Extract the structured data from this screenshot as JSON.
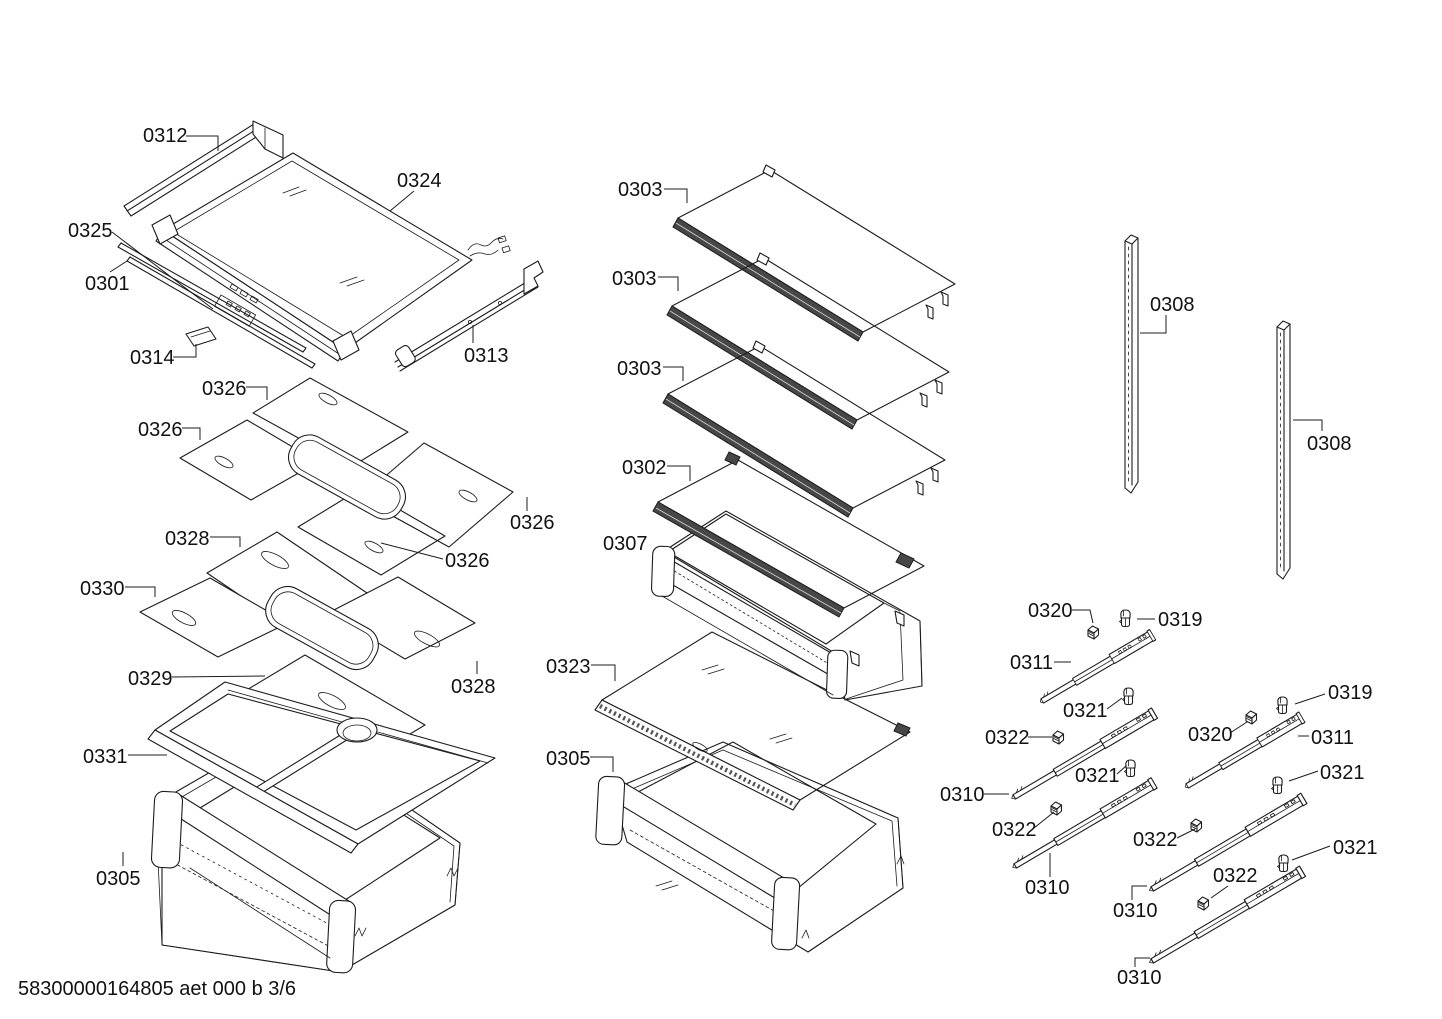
{
  "doc": {
    "footer_code": "58300000164805 aet 000 b 3/6",
    "type_note": "exploded-parts-diagram"
  },
  "colors": {
    "background": "#ffffff",
    "line": "#1c1c1c",
    "dark_edge": "#474747"
  },
  "labels": [
    {
      "text": "0312",
      "x": 143,
      "y": 142
    },
    {
      "text": "0324",
      "x": 397,
      "y": 187
    },
    {
      "text": "0325",
      "x": 68,
      "y": 237
    },
    {
      "text": "0301",
      "x": 85,
      "y": 290
    },
    {
      "text": "0314",
      "x": 130,
      "y": 364
    },
    {
      "text": "0313",
      "x": 464,
      "y": 362
    },
    {
      "text": "0326",
      "x": 202,
      "y": 395
    },
    {
      "text": "0326",
      "x": 138,
      "y": 436
    },
    {
      "text": "0326",
      "x": 510,
      "y": 529
    },
    {
      "text": "0326",
      "x": 445,
      "y": 567
    },
    {
      "text": "0328",
      "x": 165,
      "y": 545
    },
    {
      "text": "0330",
      "x": 80,
      "y": 595
    },
    {
      "text": "0329",
      "x": 128,
      "y": 685
    },
    {
      "text": "0328",
      "x": 451,
      "y": 693
    },
    {
      "text": "0331",
      "x": 83,
      "y": 763
    },
    {
      "text": "0305",
      "x": 96,
      "y": 885
    },
    {
      "text": "0303",
      "x": 618,
      "y": 196
    },
    {
      "text": "0303",
      "x": 612,
      "y": 285
    },
    {
      "text": "0303",
      "x": 617,
      "y": 375
    },
    {
      "text": "0302",
      "x": 622,
      "y": 474
    },
    {
      "text": "0307",
      "x": 603,
      "y": 550
    },
    {
      "text": "0323",
      "x": 546,
      "y": 673
    },
    {
      "text": "0305",
      "x": 546,
      "y": 765
    },
    {
      "text": "0308",
      "x": 1150,
      "y": 311
    },
    {
      "text": "0308",
      "x": 1307,
      "y": 450
    },
    {
      "text": "0320",
      "x": 1028,
      "y": 617
    },
    {
      "text": "0319",
      "x": 1158,
      "y": 626
    },
    {
      "text": "0311",
      "x": 1010,
      "y": 669
    },
    {
      "text": "0321",
      "x": 1063,
      "y": 717
    },
    {
      "text": "0322",
      "x": 985,
      "y": 744
    },
    {
      "text": "0310",
      "x": 940,
      "y": 801
    },
    {
      "text": "0321",
      "x": 1075,
      "y": 782
    },
    {
      "text": "0322",
      "x": 992,
      "y": 836
    },
    {
      "text": "0310",
      "x": 1025,
      "y": 894
    },
    {
      "text": "0319",
      "x": 1328,
      "y": 699
    },
    {
      "text": "0320",
      "x": 1188,
      "y": 741
    },
    {
      "text": "0311",
      "x": 1311,
      "y": 744
    },
    {
      "text": "0321",
      "x": 1320,
      "y": 779
    },
    {
      "text": "0322",
      "x": 1133,
      "y": 846
    },
    {
      "text": "0310",
      "x": 1113,
      "y": 917
    },
    {
      "text": "0321",
      "x": 1333,
      "y": 854
    },
    {
      "text": "0322",
      "x": 1213,
      "y": 882
    },
    {
      "text": "0310",
      "x": 1117,
      "y": 984
    }
  ]
}
